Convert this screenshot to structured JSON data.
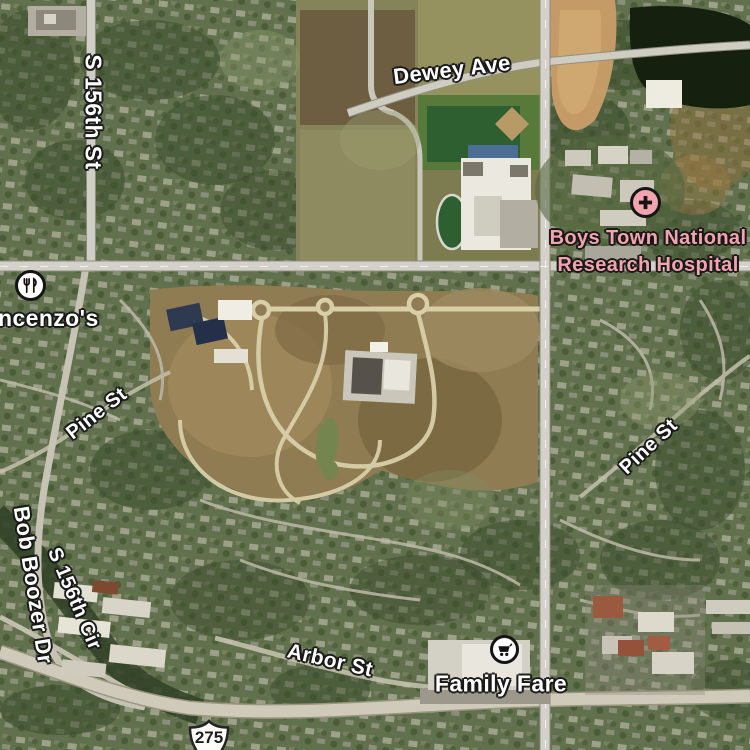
{
  "map": {
    "view": "satellite",
    "labels": {
      "dewey_ave": "Dewey Ave",
      "s_156th_st": "S 156th St",
      "pine_st_west": "Pine St",
      "pine_st_east": "Pine St",
      "bob_boozer_dr": "Bob Boozer Dr",
      "s_156th_cir": "S 156th Cir",
      "arbor_st": "Arbor St",
      "route_275": "275"
    },
    "pois": {
      "boys_town": {
        "line1": "Boys Town National",
        "line2": "Research Hospital",
        "icon": "hospital-cross-icon",
        "color": "#f2a4ae"
      },
      "vincenzos": {
        "text": "ncenzo's",
        "icon": "fork-knife-icon"
      },
      "family_fare": {
        "text": "Family Fare",
        "icon": "shopping-cart-icon"
      }
    },
    "colors": {
      "street_label": "#ffffff",
      "label_outline": "#181818",
      "hospital_pink": "#f2a4ae",
      "shield_fill": "#fdfdf8",
      "shield_text": "#1d1d1d",
      "major_road": "#d3d1c9",
      "construction_dirt": "#8f7c52",
      "lake_water": "#16200f"
    }
  }
}
